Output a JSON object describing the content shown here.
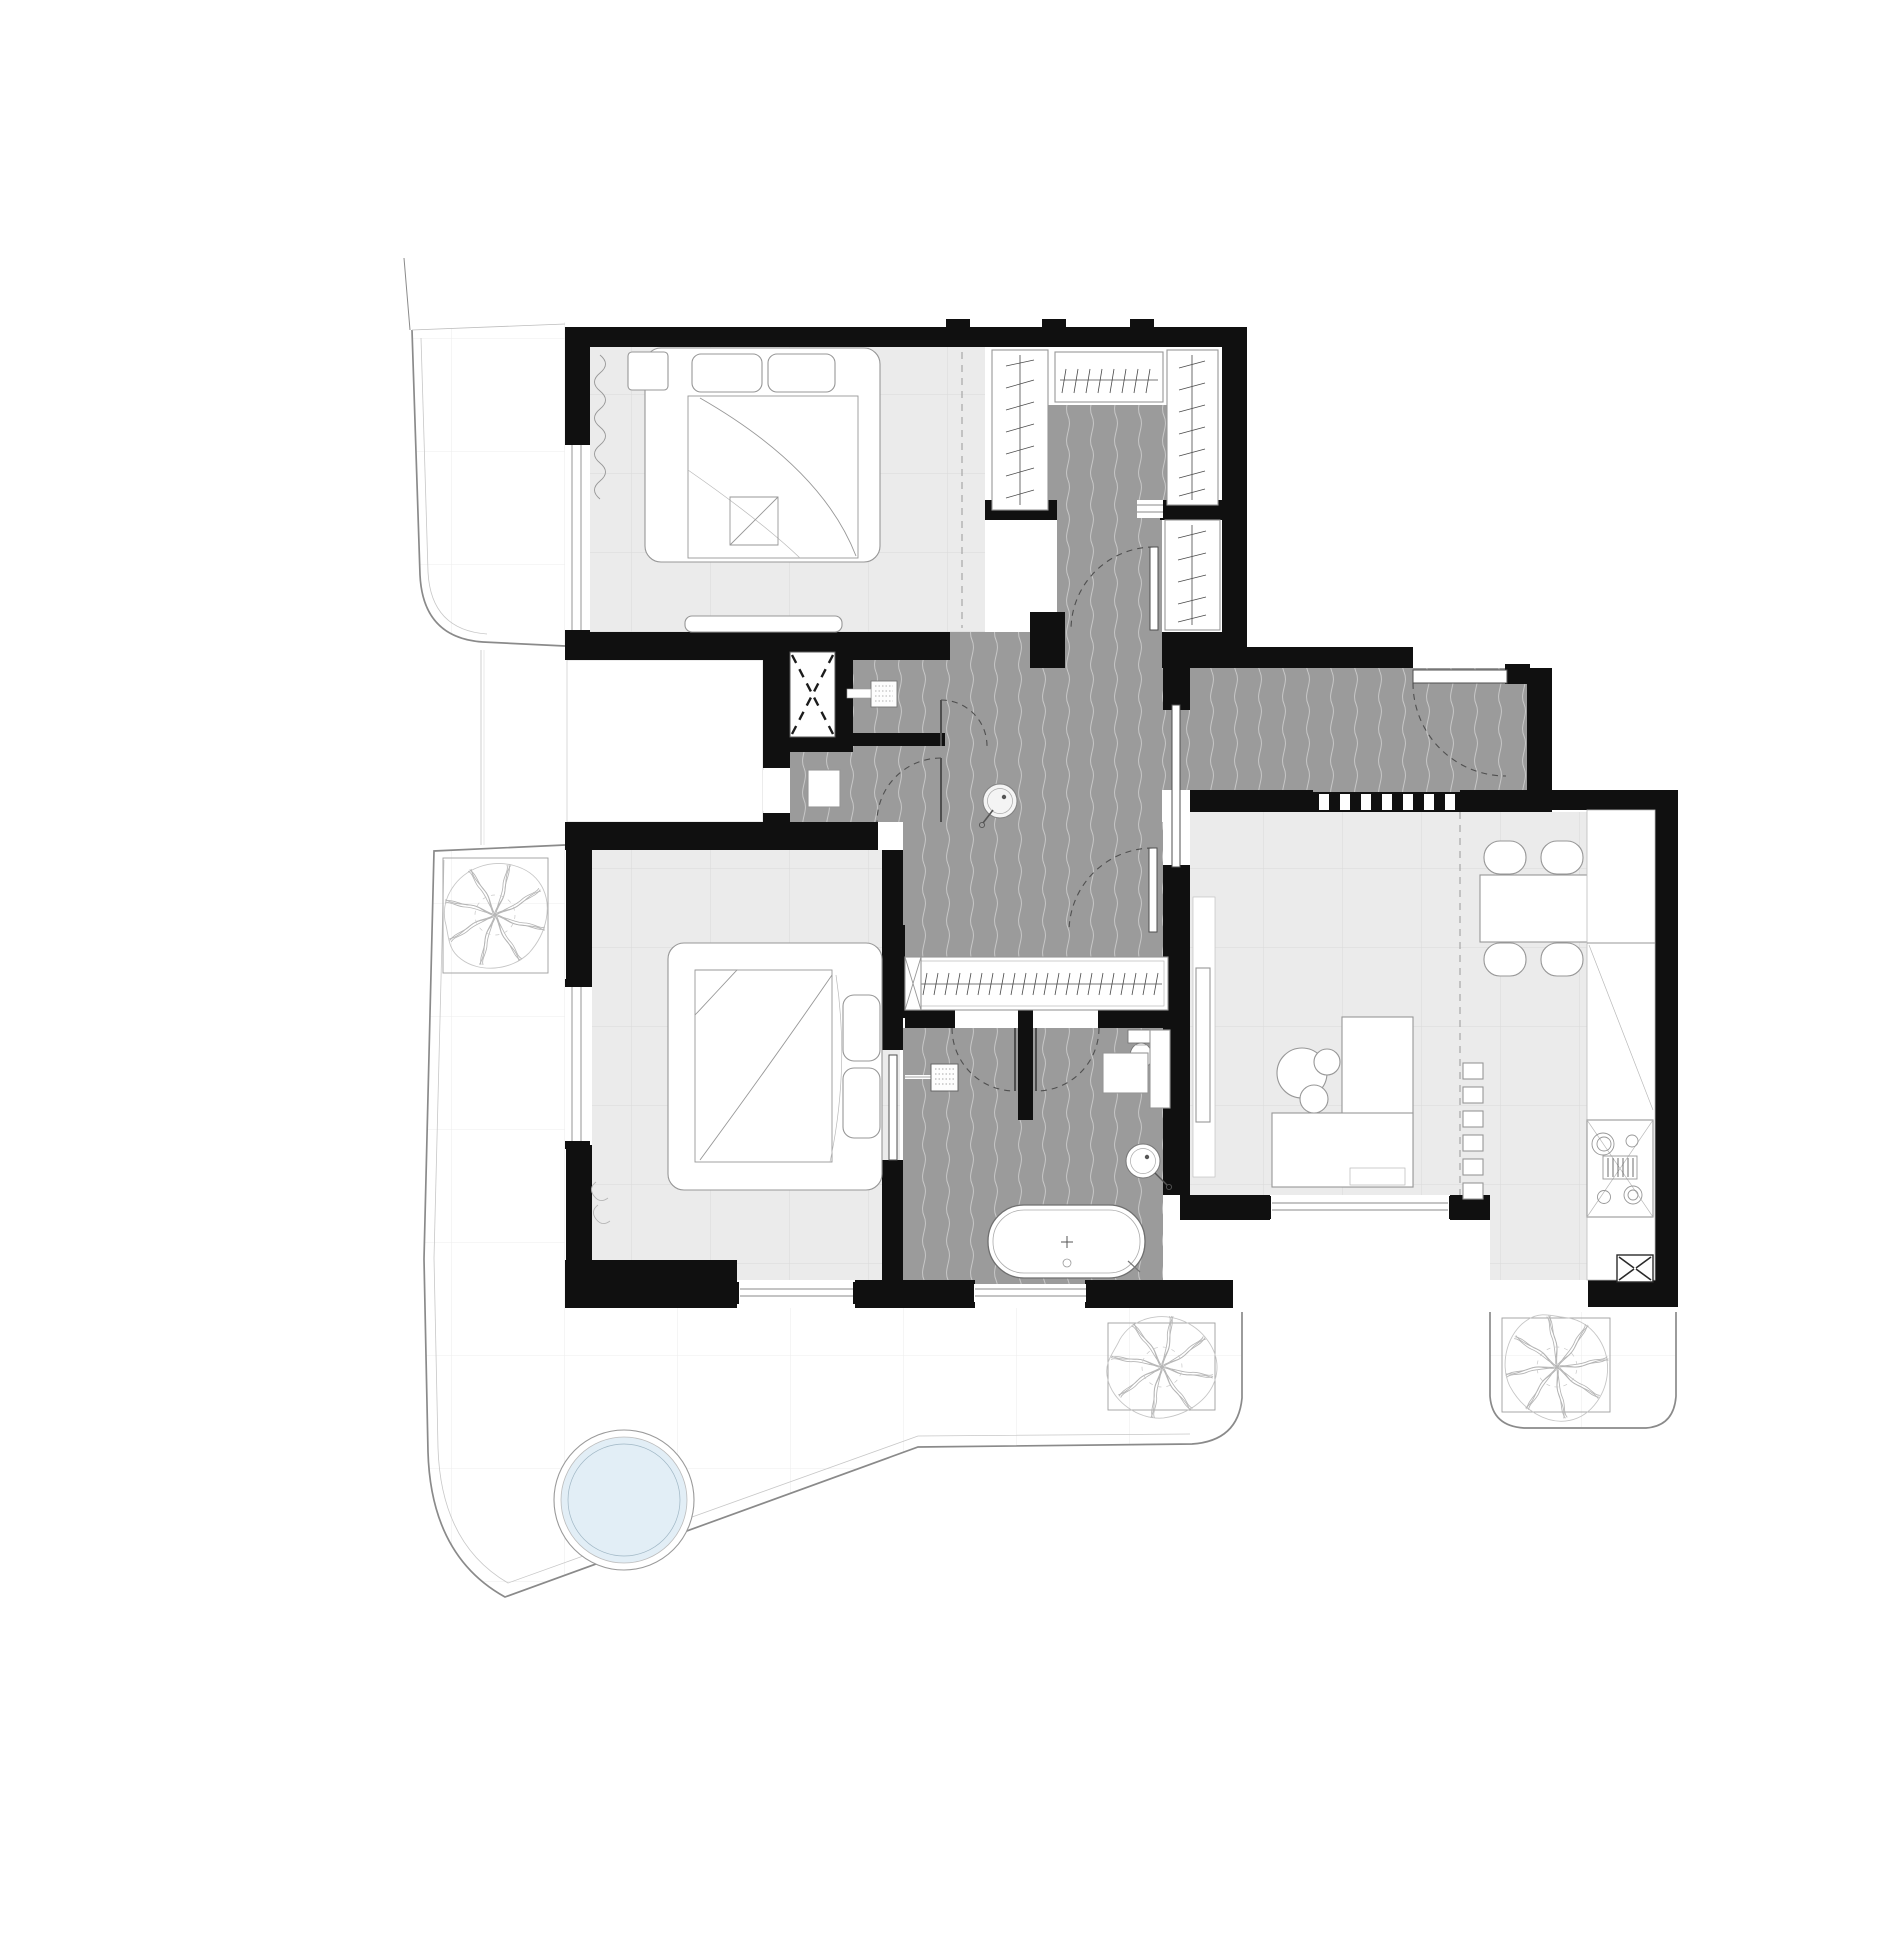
{
  "document": {
    "title": "Apartment floor plan drawing",
    "type": "architectural-plan",
    "visible_text": []
  },
  "colors": {
    "wall": "#101010",
    "hall_floor": "#9b9b9b",
    "hall_wave": "#c7c7c7",
    "room_tile": "#ebebeb",
    "room_tile_line": "#dadada",
    "terrace_tile_line": "#ededed",
    "terrace_line": "#8a8a8a",
    "furniture_fill": "#ffffff",
    "furniture_stroke": "#979797",
    "door_color": "#4f4f4f",
    "pool_water": "#e2eef6",
    "pool_rim": "#9fb6c4",
    "plant": "#b5b5b5",
    "paper": "#ffffff"
  },
  "inventory": {
    "rooms": [
      {
        "id": "bedroom-upper",
        "floor": "tile"
      },
      {
        "id": "walk-in-closet",
        "floor": "carpet"
      },
      {
        "id": "hallway",
        "floor": "carpet"
      },
      {
        "id": "entry-hall",
        "floor": "carpet"
      },
      {
        "id": "laundry-nook",
        "floor": "carpet"
      },
      {
        "id": "storage-room",
        "floor": "plain"
      },
      {
        "id": "elevator-shaft",
        "floor": "plain"
      },
      {
        "id": "master-bedroom",
        "floor": "tile"
      },
      {
        "id": "bathroom",
        "floor": "carpet"
      },
      {
        "id": "living-dining-room",
        "floor": "tile"
      },
      {
        "id": "kitchen",
        "floor": "tile"
      },
      {
        "id": "terrace-upper-left",
        "floor": "paving"
      },
      {
        "id": "terrace-lower",
        "floor": "paving"
      },
      {
        "id": "terrace-lower-right",
        "floor": "paving"
      }
    ],
    "objects": {
      "beds": 2,
      "pillows": 4,
      "nightstands": 1,
      "wardrobes": 5,
      "dining_chairs": 4,
      "dining_tables": 1,
      "sofa_sections": 2,
      "coffee_tables": 3,
      "tv_console": 1,
      "sideboard_units": 6,
      "bathtubs": 1,
      "shower_heads": 1,
      "toilets": 1,
      "round_washbasins": 2,
      "washer_drain": 1,
      "cooktop_burners": 4,
      "service_shafts": 2,
      "swing_doors": 7,
      "sliding_doors": 2,
      "windows": 6,
      "trees": 3,
      "pools": 1
    }
  }
}
